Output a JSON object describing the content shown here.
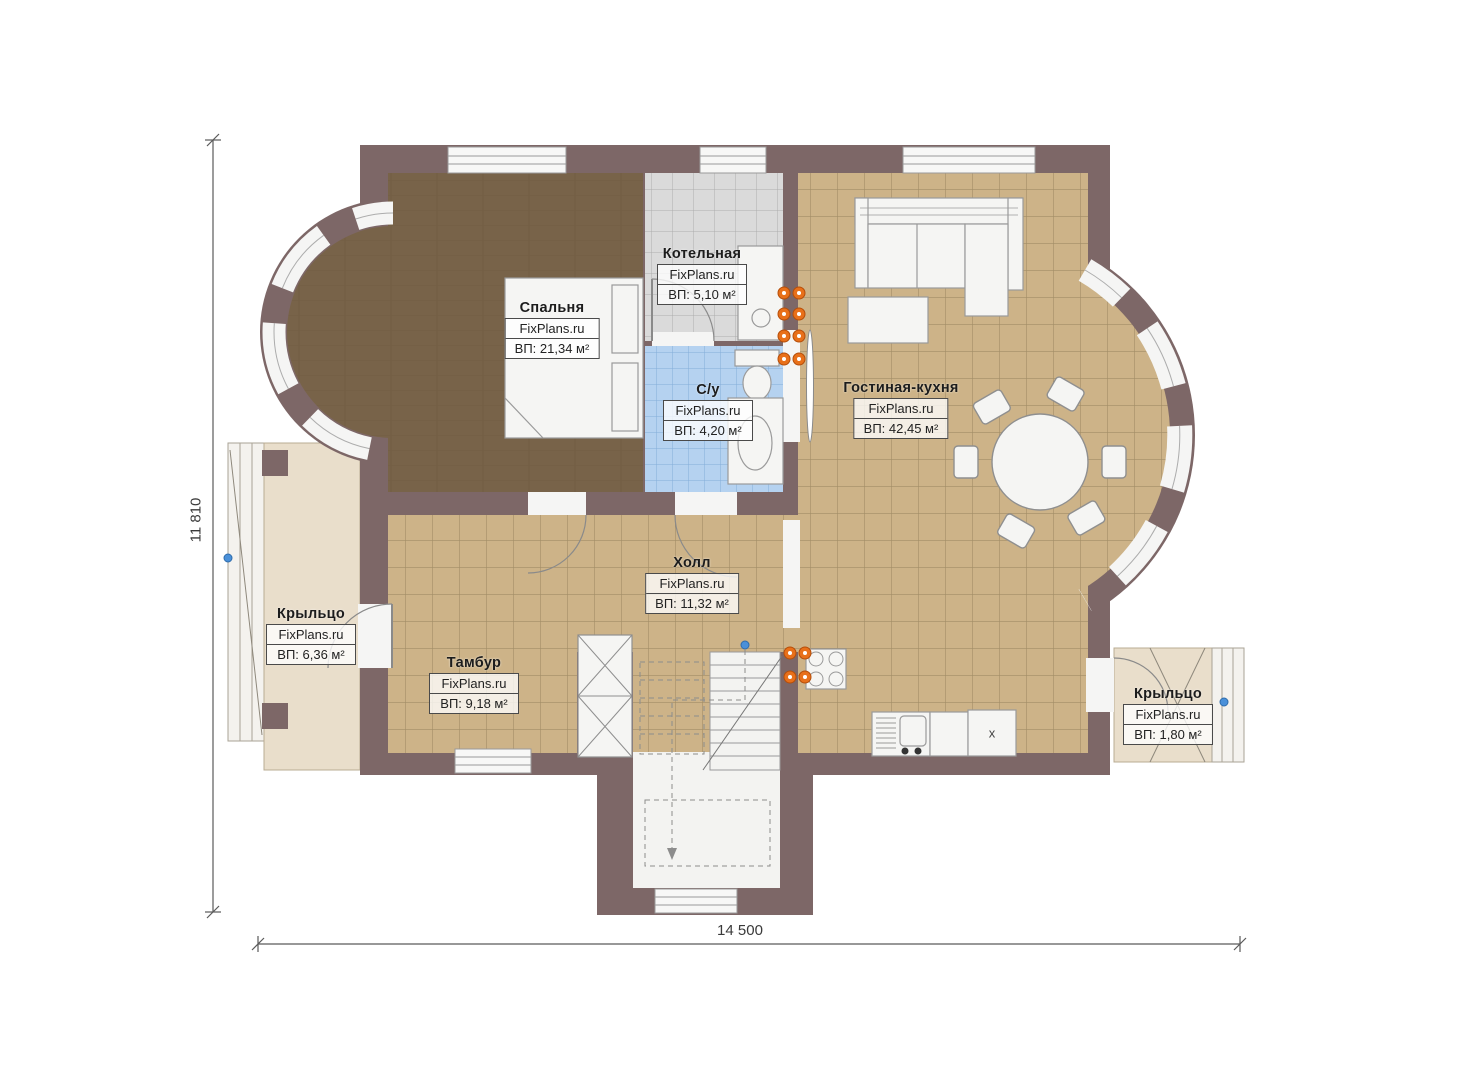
{
  "plan": {
    "brand": "FixPlans.ru",
    "rooms": [
      {
        "id": "bedroom",
        "name": "Спальня",
        "brand": "FixPlans.ru",
        "area": "ВП: 21,34 м²"
      },
      {
        "id": "boiler",
        "name": "Котельная",
        "brand": "FixPlans.ru",
        "area": "ВП: 5,10 м²"
      },
      {
        "id": "wc",
        "name": "С/у",
        "brand": "FixPlans.ru",
        "area": "ВП: 4,20 м²"
      },
      {
        "id": "living",
        "name": "Гостиная-кухня",
        "brand": "FixPlans.ru",
        "area": "ВП: 42,45 м²"
      },
      {
        "id": "hall",
        "name": "Холл",
        "brand": "FixPlans.ru",
        "area": "ВП: 11,32 м²"
      },
      {
        "id": "porch-left",
        "name": "Крыльцо",
        "brand": "FixPlans.ru",
        "area": "ВП: 6,36 м²"
      },
      {
        "id": "tambour",
        "name": "Тамбур",
        "brand": "FixPlans.ru",
        "area": "ВП: 9,18 м²"
      },
      {
        "id": "porch-right",
        "name": "Крыльцо",
        "brand": "FixPlans.ru",
        "area": "ВП: 1,80 м²"
      }
    ],
    "dimensions": {
      "width": "14 500",
      "height": "11 810"
    },
    "kitchen_unit_mark": "x",
    "colors": {
      "wall": "#7d6767",
      "wood_floor": "#786349",
      "tile_tan": "#cdb388",
      "tile_gray": "#dadada",
      "tile_blue": "#b5d2f0",
      "porch": "#e9decb",
      "radiator": "#e8701a"
    }
  }
}
